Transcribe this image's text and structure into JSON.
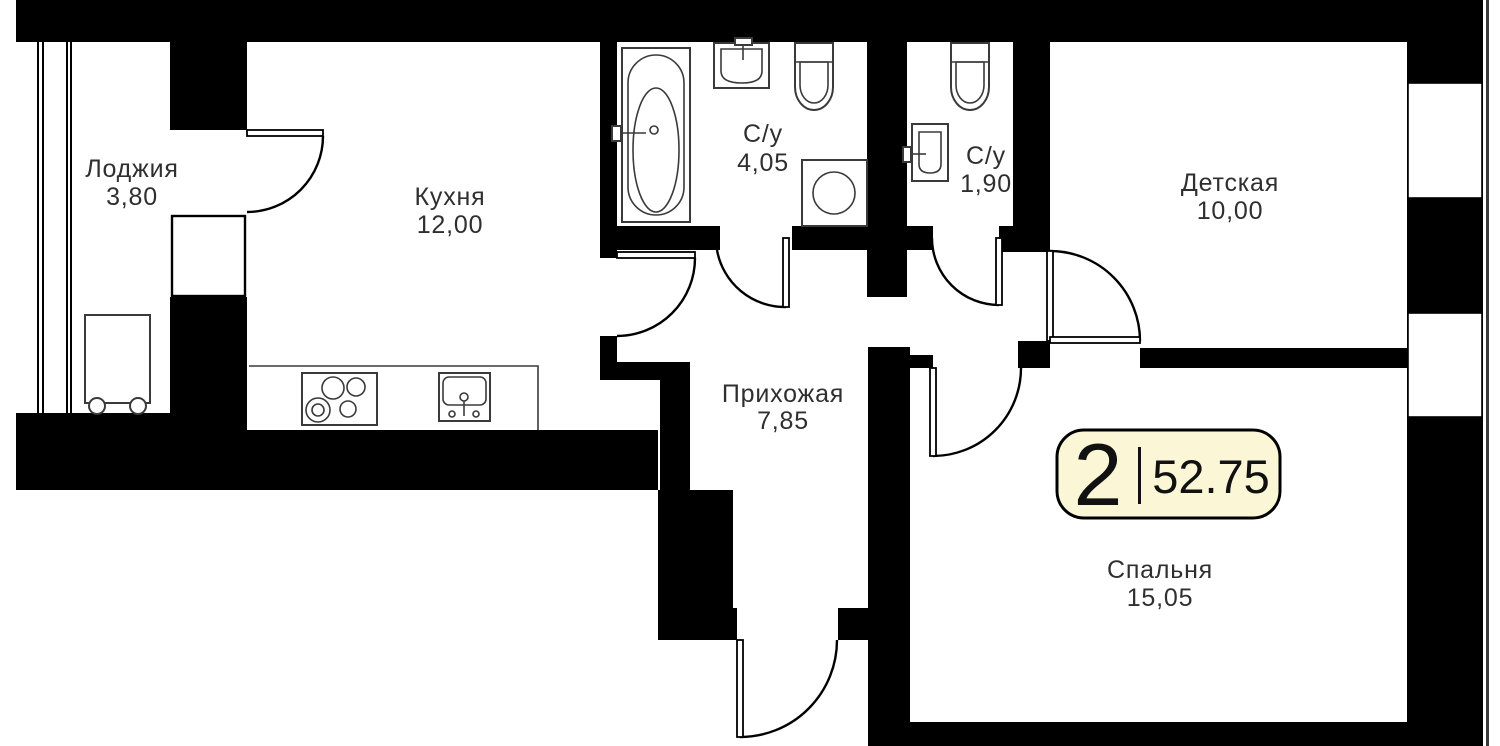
{
  "plan": {
    "title": "floor-plan",
    "badge": {
      "rooms_count": "2",
      "area_total": "52.75"
    },
    "rooms": [
      {
        "name": "Лоджия",
        "area": "3,80"
      },
      {
        "name": "Кухня",
        "area": "12,00"
      },
      {
        "name": "С/у",
        "area": "4,05"
      },
      {
        "name": "С/у",
        "area": "1,90"
      },
      {
        "name": "Детская",
        "area": "10,00"
      },
      {
        "name": "Прихожая",
        "area": "7,85"
      },
      {
        "name": "Спальня",
        "area": "15,05"
      }
    ],
    "colors": {
      "wall": "#000000",
      "badge_fill": "#fbf7d6",
      "badge_border": "#000000",
      "label_text": "#2f2f2f"
    }
  }
}
